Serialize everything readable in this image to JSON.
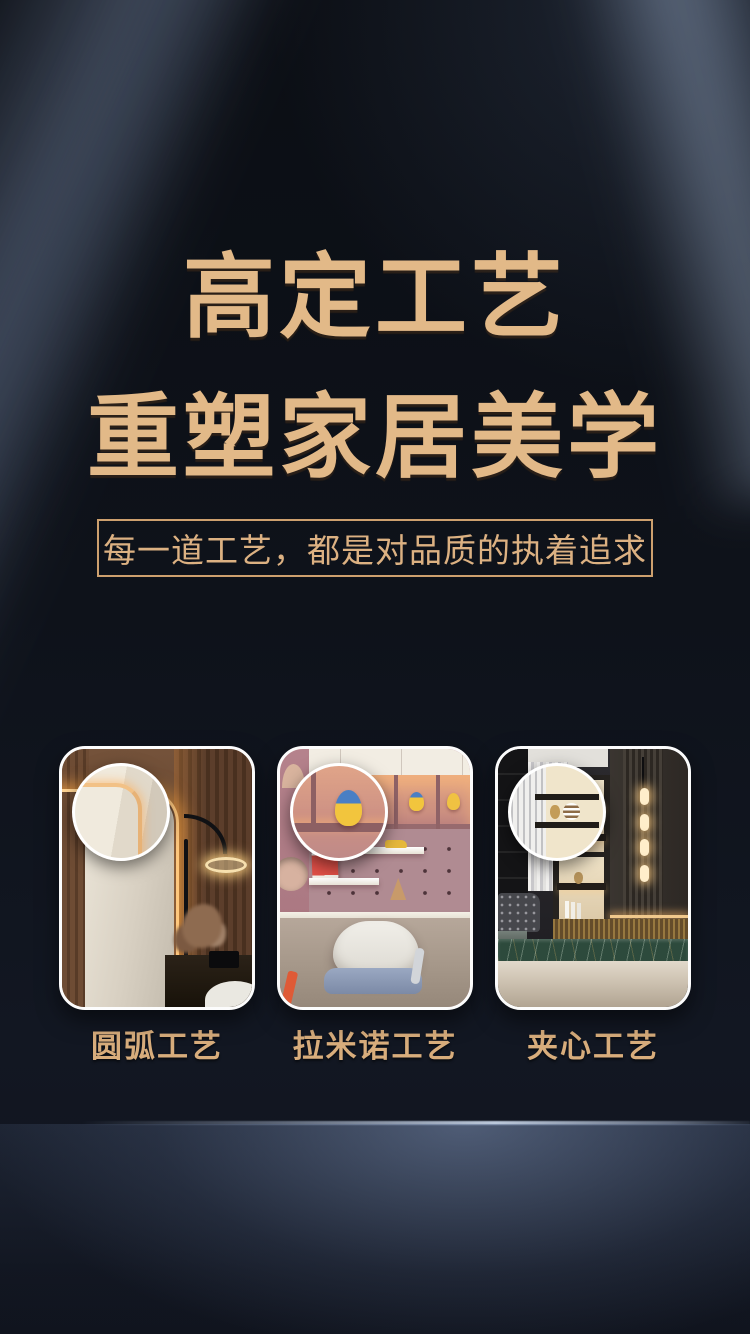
{
  "headline": {
    "line1": "高定工艺",
    "line2": "重塑家居美学"
  },
  "subtitle": {
    "text": "每一道工艺，都是对品质的执着追求"
  },
  "cards": [
    {
      "label": "圆弧工艺",
      "scene": "rounded-arc-cabinet-edge-closeup"
    },
    {
      "label": "拉米诺工艺",
      "scene": "kids-study-desk-closeup"
    },
    {
      "label": "夹心工艺",
      "scene": "display-shelving-closeup"
    }
  ],
  "colors": {
    "gold_text": "#e2b988",
    "gold_border": "#cda06e",
    "label_gold": "#d8ad7c",
    "background": "#0d1118",
    "card_border": "#ffffff",
    "led_glow": "#ffc87e"
  }
}
